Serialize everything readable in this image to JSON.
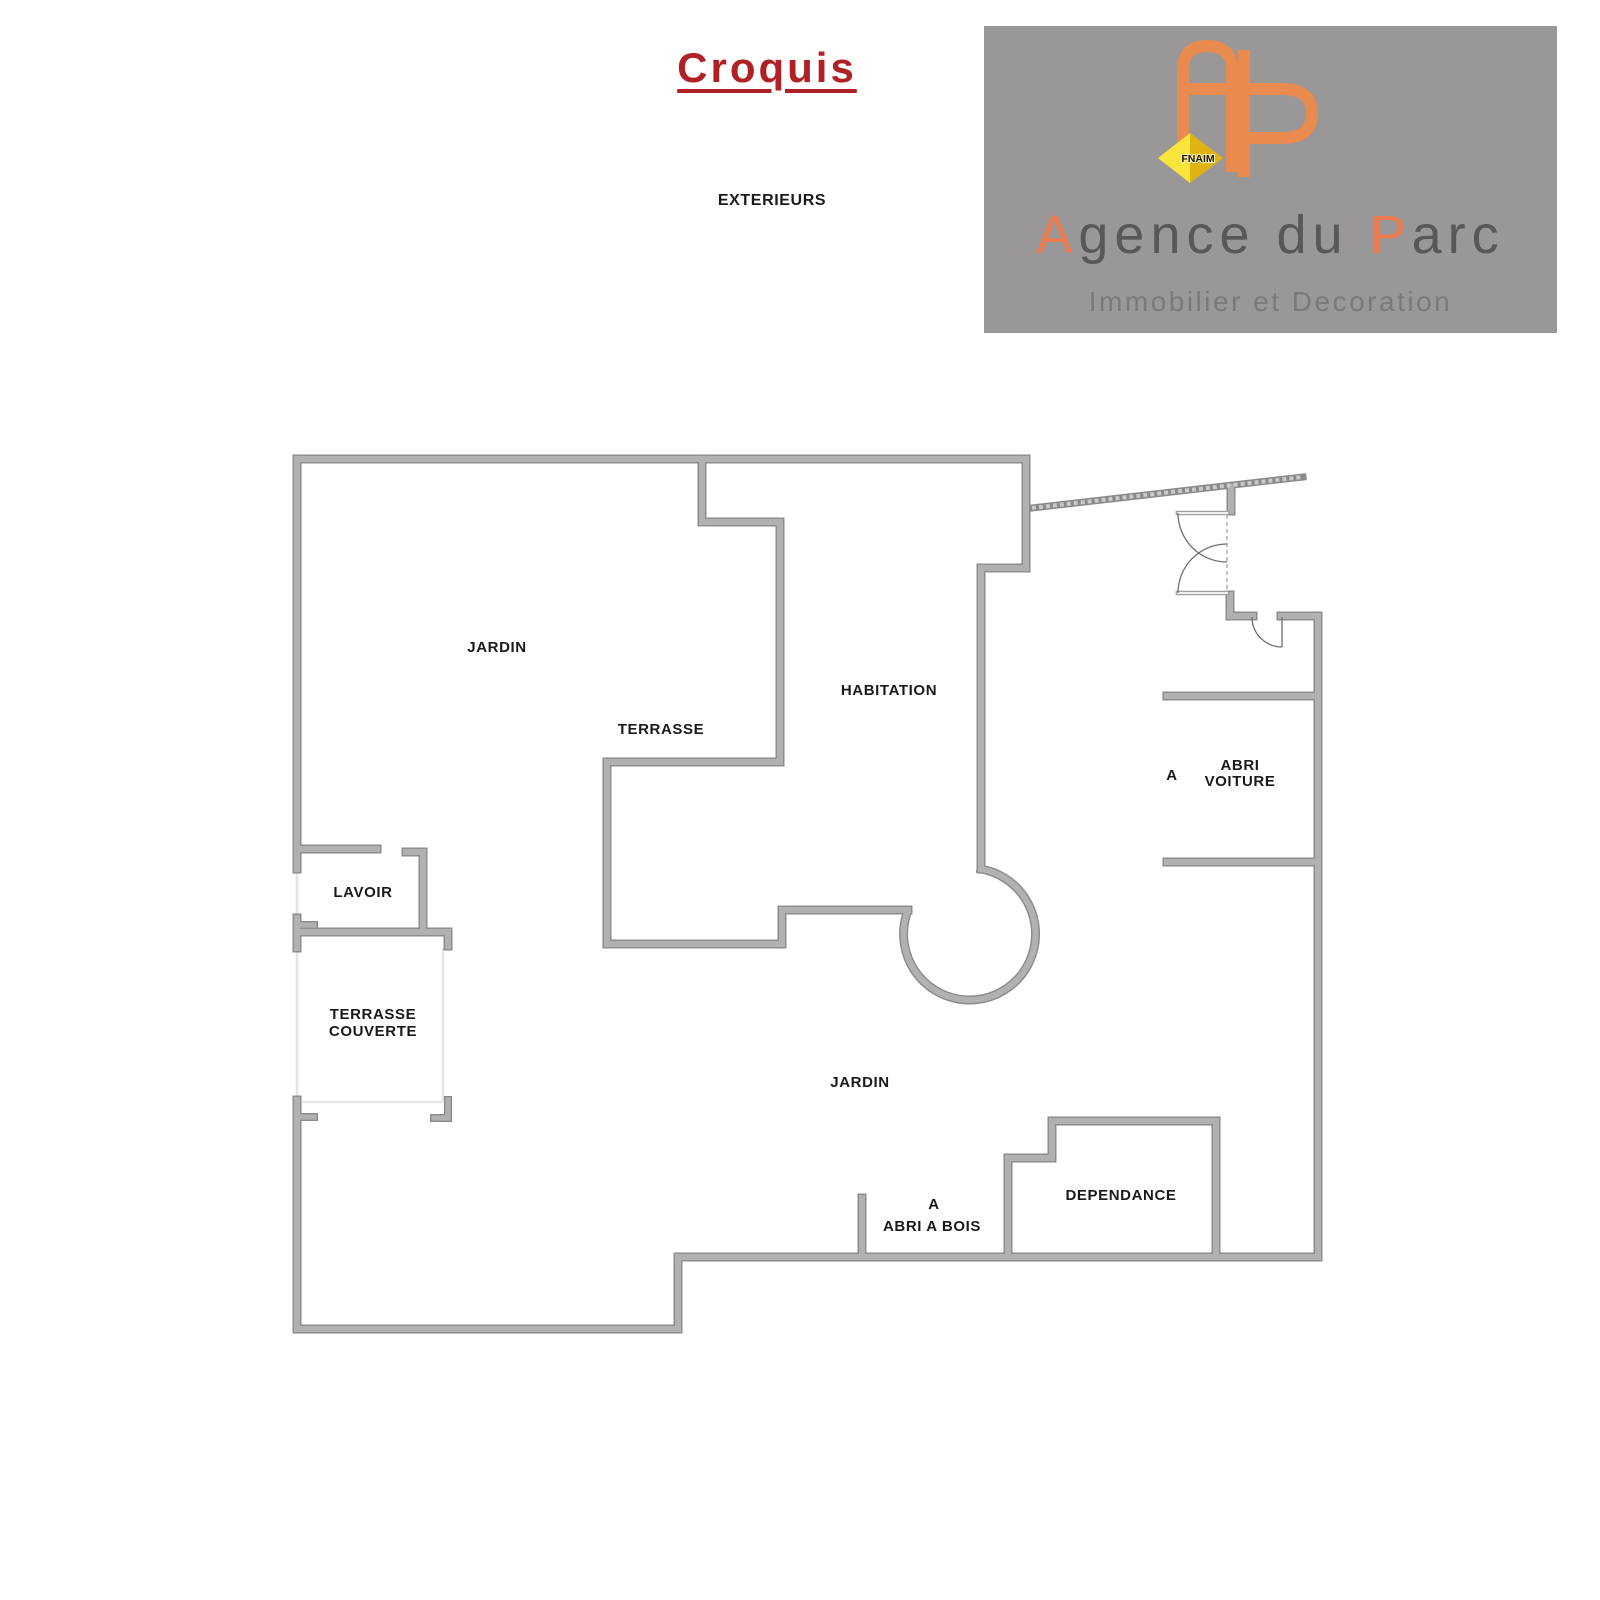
{
  "header": {
    "title": "Croquis",
    "title_color": "#B02126"
  },
  "logo": {
    "background": "#9A9798",
    "monogram_color": "#E98A4E",
    "badge_text": "FNAIM",
    "gem": {
      "bright": "#F9E53B",
      "dark": "#E0B313",
      "text_color": "#181305"
    },
    "brand_parts": [
      {
        "t": "A",
        "c": "#EF7A4E"
      },
      {
        "t": "gence du ",
        "c": "#58585A"
      },
      {
        "t": "P",
        "c": "#EF7A4E"
      },
      {
        "t": "arc",
        "c": "#58585A"
      }
    ],
    "subtitle": "Immobilier et Decoration"
  },
  "plan": {
    "colors": {
      "wall_edge": "#8A8A8A",
      "wall_fill": "#B1B1B1",
      "light_line": "#E5E5E5",
      "thin_edge": "#9A9A9A",
      "thin_fill": "#EFEFEF",
      "door_line": "#6E6E6E",
      "dash_line": "#9B9B9B",
      "label_color": "#1A1A1A",
      "fence_dash": "#C9C9C9"
    },
    "walls": [
      [
        297,
        459,
        297,
        869,
        9
      ],
      [
        297,
        918,
        297,
        948,
        9
      ],
      [
        297,
        1100,
        297,
        1329,
        9
      ],
      [
        297,
        459,
        1026,
        459,
        9
      ],
      [
        702,
        459,
        702,
        522,
        9
      ],
      [
        702,
        522,
        780,
        522,
        9
      ],
      [
        780,
        522,
        780,
        762,
        9
      ],
      [
        607,
        762,
        780,
        762,
        9
      ],
      [
        607,
        762,
        607,
        944,
        9
      ],
      [
        607,
        944,
        782,
        944,
        9
      ],
      [
        782,
        910,
        782,
        944,
        9
      ],
      [
        782,
        910,
        908,
        910,
        9
      ],
      [
        1026,
        459,
        1026,
        568,
        9
      ],
      [
        981,
        568,
        1026,
        568,
        9
      ],
      [
        981,
        568,
        981,
        869,
        9
      ],
      [
        1231,
        487,
        1231,
        511,
        9
      ],
      [
        1230,
        595,
        1230,
        616,
        9
      ],
      [
        1230,
        616,
        1253,
        616,
        9
      ],
      [
        1281,
        616,
        1318,
        616,
        9
      ],
      [
        1318,
        616,
        1318,
        1257,
        9
      ],
      [
        1167,
        696,
        1318,
        696,
        9
      ],
      [
        1167,
        862,
        1318,
        862,
        9
      ],
      [
        678,
        1257,
        1318,
        1257,
        9
      ],
      [
        678,
        1257,
        678,
        1329,
        9
      ],
      [
        297,
        1329,
        678,
        1329,
        9
      ],
      [
        862,
        1198,
        862,
        1257,
        9
      ],
      [
        297,
        849,
        377,
        849,
        9
      ],
      [
        406,
        852,
        423,
        852,
        9
      ],
      [
        423,
        852,
        423,
        932,
        9
      ],
      [
        297,
        932,
        448,
        932,
        9
      ],
      [
        448,
        932,
        448,
        946,
        9
      ],
      [
        297,
        925,
        314,
        925,
        8
      ],
      [
        297,
        1117,
        314,
        1117,
        8
      ],
      [
        448,
        1100,
        448,
        1118,
        8
      ],
      [
        434,
        1118,
        448,
        1118,
        8
      ]
    ],
    "wall_paths": [
      {
        "name": "round-bay-wall",
        "d": "M 981,869 A 66 66 0 1 1 907,913",
        "w": 9
      },
      {
        "name": "dependance-wall",
        "d": "M 1008,1257 L 1008,1158 L 1052,1158 L 1052,1121 L 1216,1121 L 1216,1257",
        "w": 9
      }
    ],
    "fence": [
      1032,
      508,
      1303,
      477
    ],
    "thin_walls": [
      [
        1178,
        513,
        1227,
        513
      ],
      [
        1178,
        593,
        1227,
        593
      ]
    ],
    "door_arcs": [
      "M 1178,513 A 49 49 0 0 0 1227,562",
      "M 1178,593 A 49 49 0 0 1 1227,544",
      "M 1252,617 A 30 30 0 0 0 1282,647"
    ],
    "door_leaves": [
      [
        1282,
        617,
        1282,
        647
      ]
    ],
    "dashed_lines": [
      [
        1227,
        515,
        1227,
        591
      ]
    ],
    "light_lines": [
      [
        297,
        869,
        297,
        918
      ],
      [
        297,
        948,
        297,
        1100
      ],
      [
        443,
        948,
        443,
        1102
      ],
      [
        297,
        1102,
        443,
        1102
      ]
    ],
    "labels": [
      {
        "id": "exterieurs",
        "t": "EXTERIEURS",
        "x": 772,
        "y": 201,
        "s": 16
      },
      {
        "id": "jardin-nord",
        "t": "JARDIN",
        "x": 497,
        "y": 648,
        "s": 15
      },
      {
        "id": "terrasse",
        "t": "TERRASSE",
        "x": 661,
        "y": 730,
        "s": 15
      },
      {
        "id": "habitation",
        "t": "HABITATION",
        "x": 889,
        "y": 691,
        "s": 15
      },
      {
        "id": "lavoir",
        "t": "LAVOIR",
        "x": 363,
        "y": 893,
        "s": 15
      },
      {
        "id": "terrasse-couverte-1",
        "t": "TERRASSE",
        "x": 373,
        "y": 1015,
        "s": 15
      },
      {
        "id": "terrasse-couverte-2",
        "t": "COUVERTE",
        "x": 373,
        "y": 1032,
        "s": 15
      },
      {
        "id": "abri-voiture-a",
        "t": "A",
        "x": 1172,
        "y": 776,
        "s": 15
      },
      {
        "id": "abri-voiture-1",
        "t": "ABRI",
        "x": 1240,
        "y": 766,
        "s": 15
      },
      {
        "id": "abri-voiture-2",
        "t": "VOITURE",
        "x": 1240,
        "y": 782,
        "s": 15
      },
      {
        "id": "jardin-sud",
        "t": "JARDIN",
        "x": 860,
        "y": 1083,
        "s": 15
      },
      {
        "id": "abri-a-bois-a",
        "t": "A",
        "x": 934,
        "y": 1205,
        "s": 15
      },
      {
        "id": "abri-a-bois",
        "t": "ABRI A BOIS",
        "x": 932,
        "y": 1227,
        "s": 15
      },
      {
        "id": "dependance",
        "t": "DEPENDANCE",
        "x": 1121,
        "y": 1196,
        "s": 15
      }
    ]
  }
}
